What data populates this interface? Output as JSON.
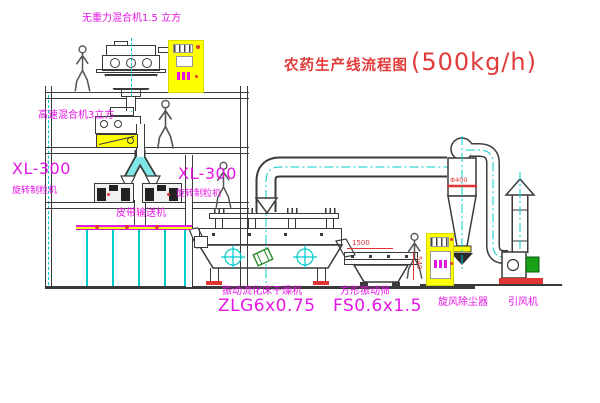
{
  "title": {
    "name": "农药生产线流程图",
    "capacity": "(500kg/h)"
  },
  "equipment": {
    "top_mixer_label": "无重力混合机1.5 立方",
    "mid_mixer_label": "高速混合机3立方",
    "granulator_left": {
      "model": "XL-300",
      "name": "旋转制粒机"
    },
    "granulator_right": {
      "model": "XL-300",
      "name": "旋转制粒机"
    },
    "belt_conveyor": "皮带输送机",
    "dryer": {
      "name": "振动流化床干燥机",
      "model": "ZLG6x0.75"
    },
    "screen": {
      "name": "方形振动筛",
      "model": "FS0.6x1.5"
    },
    "cyclone": "旋风除尘器",
    "fan": "引风机"
  },
  "dimensions": {
    "screen_length": "1500",
    "screen_height": "540",
    "cyclone_diameter": "Φ400"
  },
  "colors": {
    "label_magenta": "#e515e5",
    "annotation_red": "#e03535",
    "centerline_cyan": "#00cccc",
    "cabinet_yellow": "#ffff00",
    "motor_green": "#18a018",
    "line": "#3a3a3a"
  }
}
